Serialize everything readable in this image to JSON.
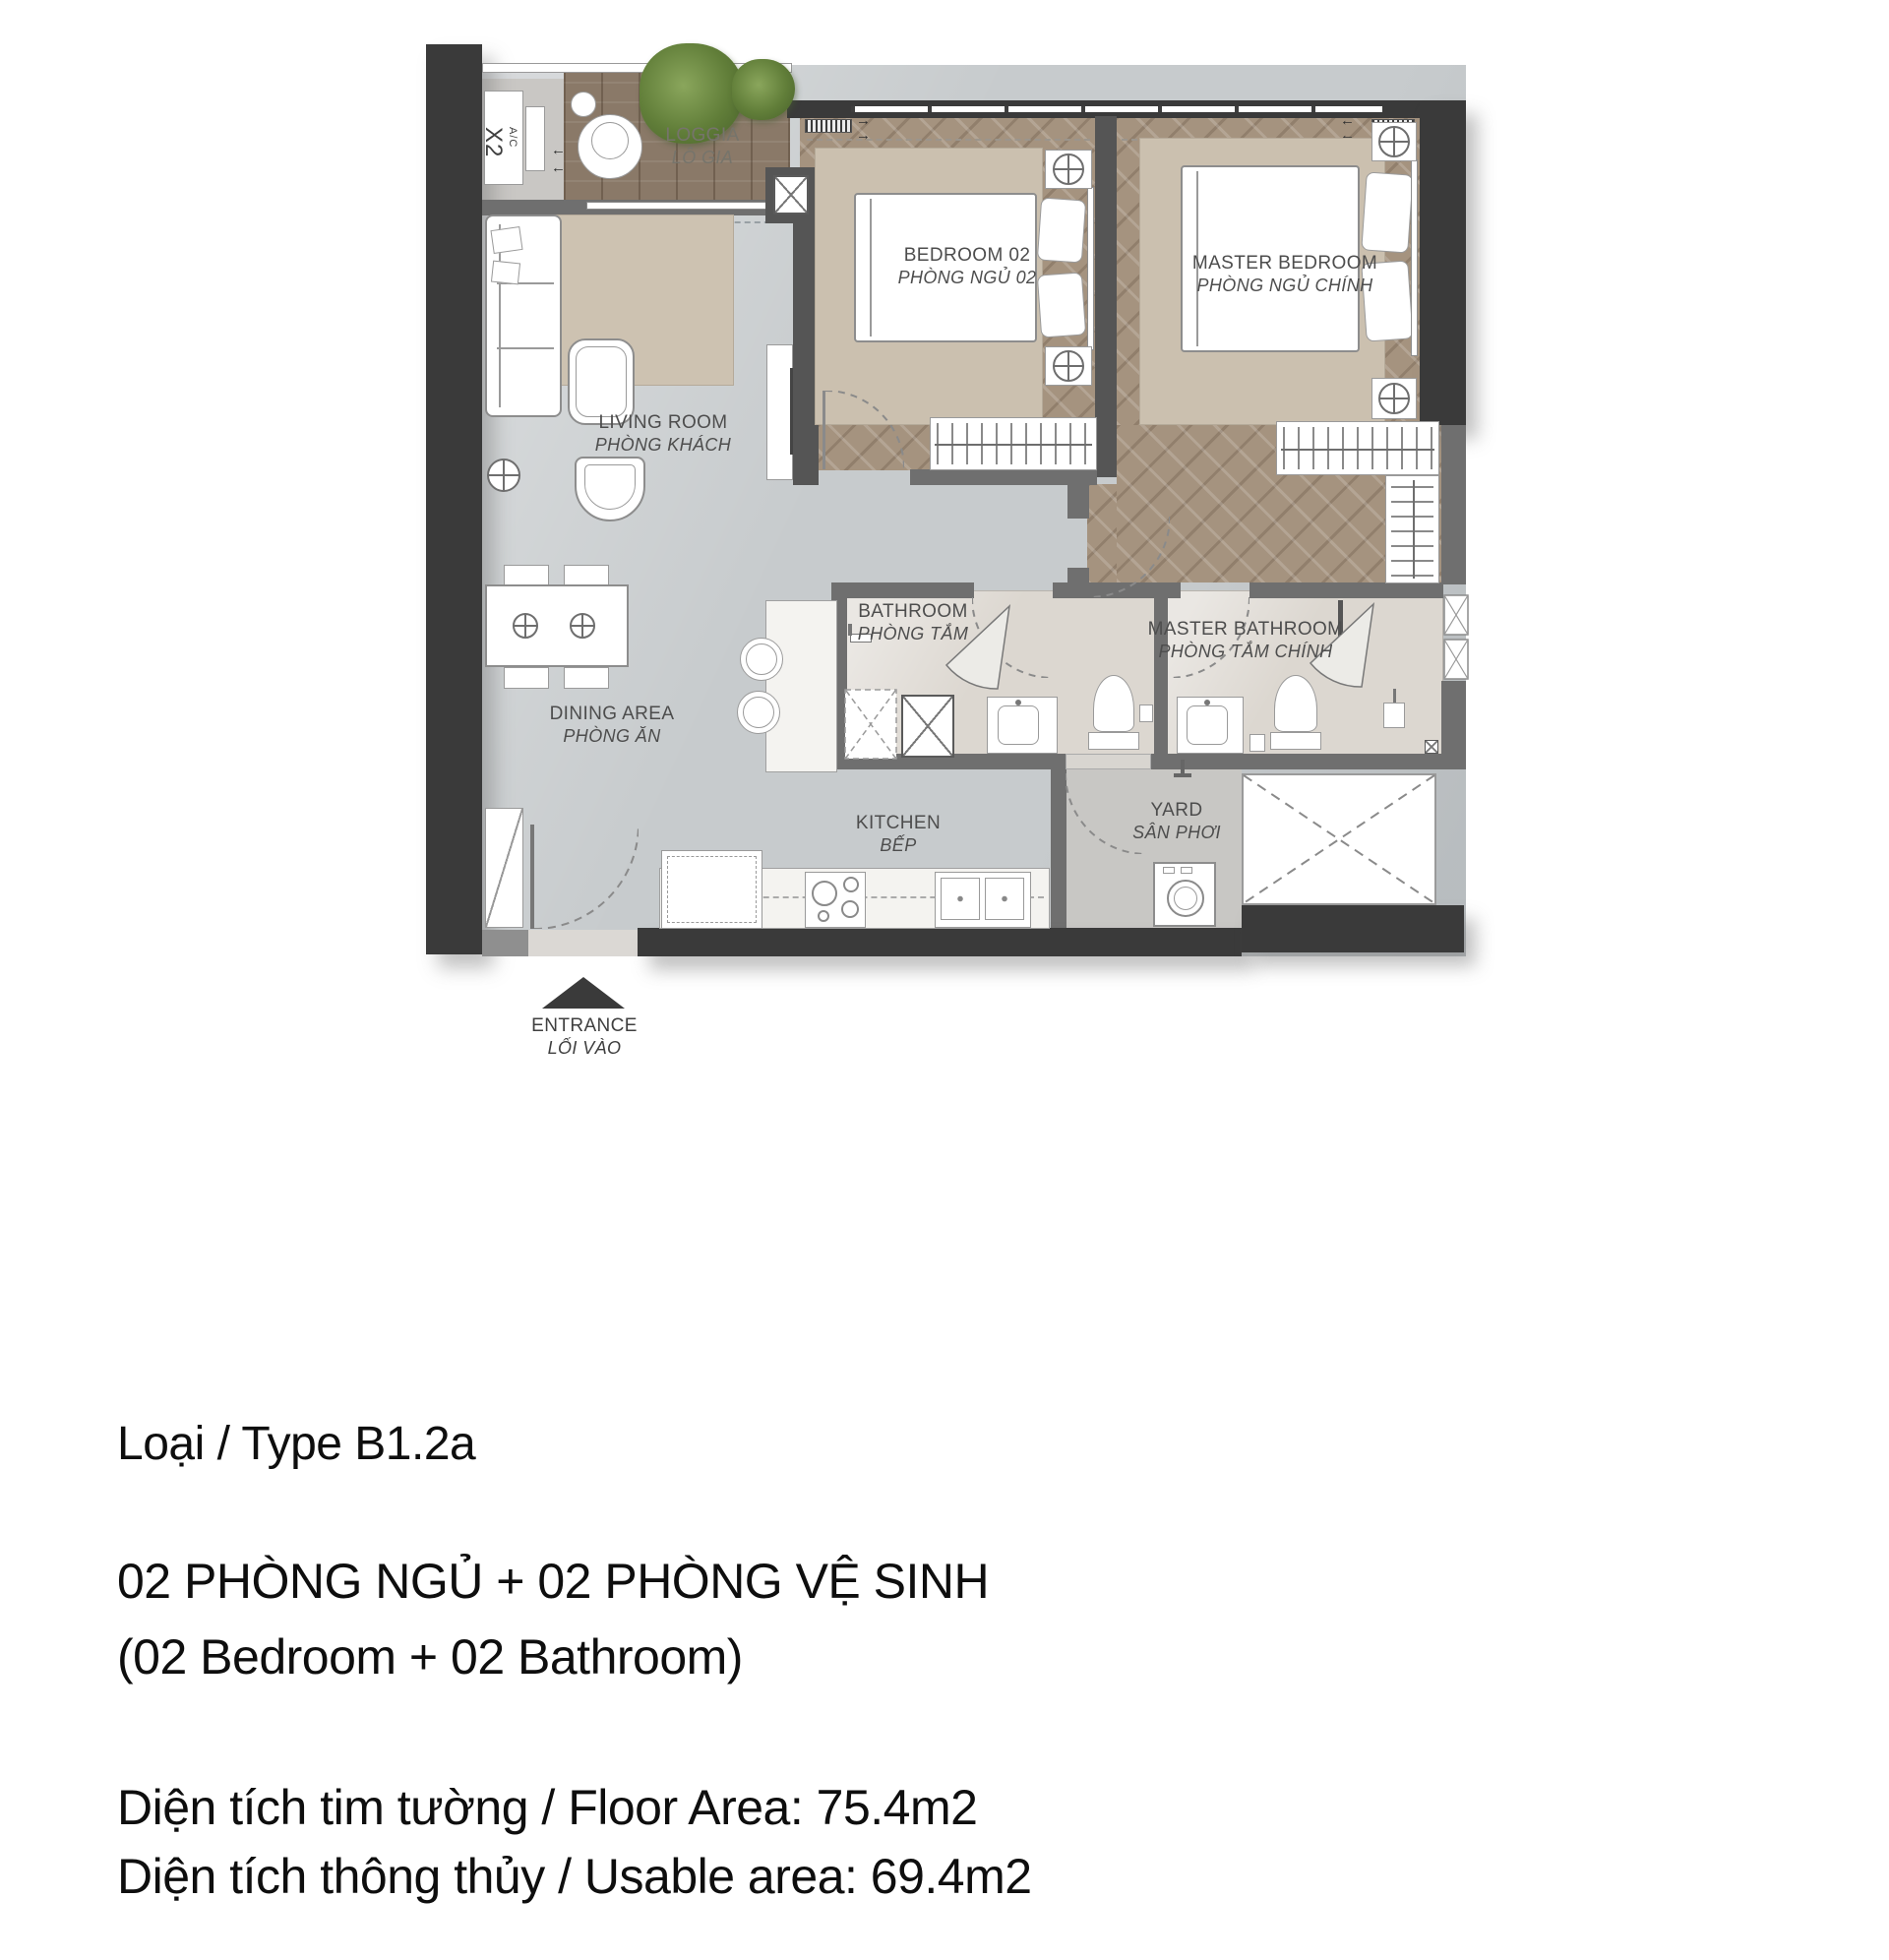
{
  "palette": {
    "wall-dark": "#3a3a3a",
    "wall-gray": "#6f6f6f",
    "wood-loggia": "#8a7968",
    "wood-herringbone": "#a5937f",
    "floor-gray": "#c7cbcd",
    "floor-bath": "#dcd7d0",
    "rug": "#cdc2b1",
    "plant-green": "#617e39",
    "label-color": "#4d4d4d",
    "text-color": "#0e0e0e"
  },
  "plan": {
    "rooms": [
      {
        "en": "LOGGIA",
        "vi": "LÔ GIA"
      },
      {
        "en": "BEDROOM 02",
        "vi": "PHÒNG NGỦ 02"
      },
      {
        "en": "MASTER BEDROOM",
        "vi": "PHÒNG NGỦ CHÍNH"
      },
      {
        "en": "LIVING ROOM",
        "vi": "PHÒNG KHÁCH"
      },
      {
        "en": "DINING AREA",
        "vi": "PHÒNG ĂN"
      },
      {
        "en": "BATHROOM",
        "vi": "PHÒNG TẮM"
      },
      {
        "en": "MASTER BATHROOM",
        "vi": "PHÒNG TẮM CHÍNH"
      },
      {
        "en": "KITCHEN",
        "vi": "BẾP"
      },
      {
        "en": "YARD",
        "vi": "SÂN PHƠI"
      },
      {
        "en": "ENTRANCE",
        "vi": "LỐI VÀO"
      }
    ],
    "ac_unit": {
      "label": "A/C",
      "count": "X2"
    },
    "icons": {
      "arrow_left": "←",
      "arrow_right": "→"
    }
  },
  "info": {
    "type_line": "Loại / Type B1.2a",
    "bedrooms_line_vi": "02 PHÒNG NGỦ + 02 PHÒNG VỆ SINH",
    "bedrooms_line_en": "(02 Bedroom + 02 Bathroom)",
    "floor_area_line": "Diện tích tim tường / Floor Area: 75.4m2",
    "usable_area_line": "Diện tích thông thủy / Usable area: 69.4m2"
  }
}
